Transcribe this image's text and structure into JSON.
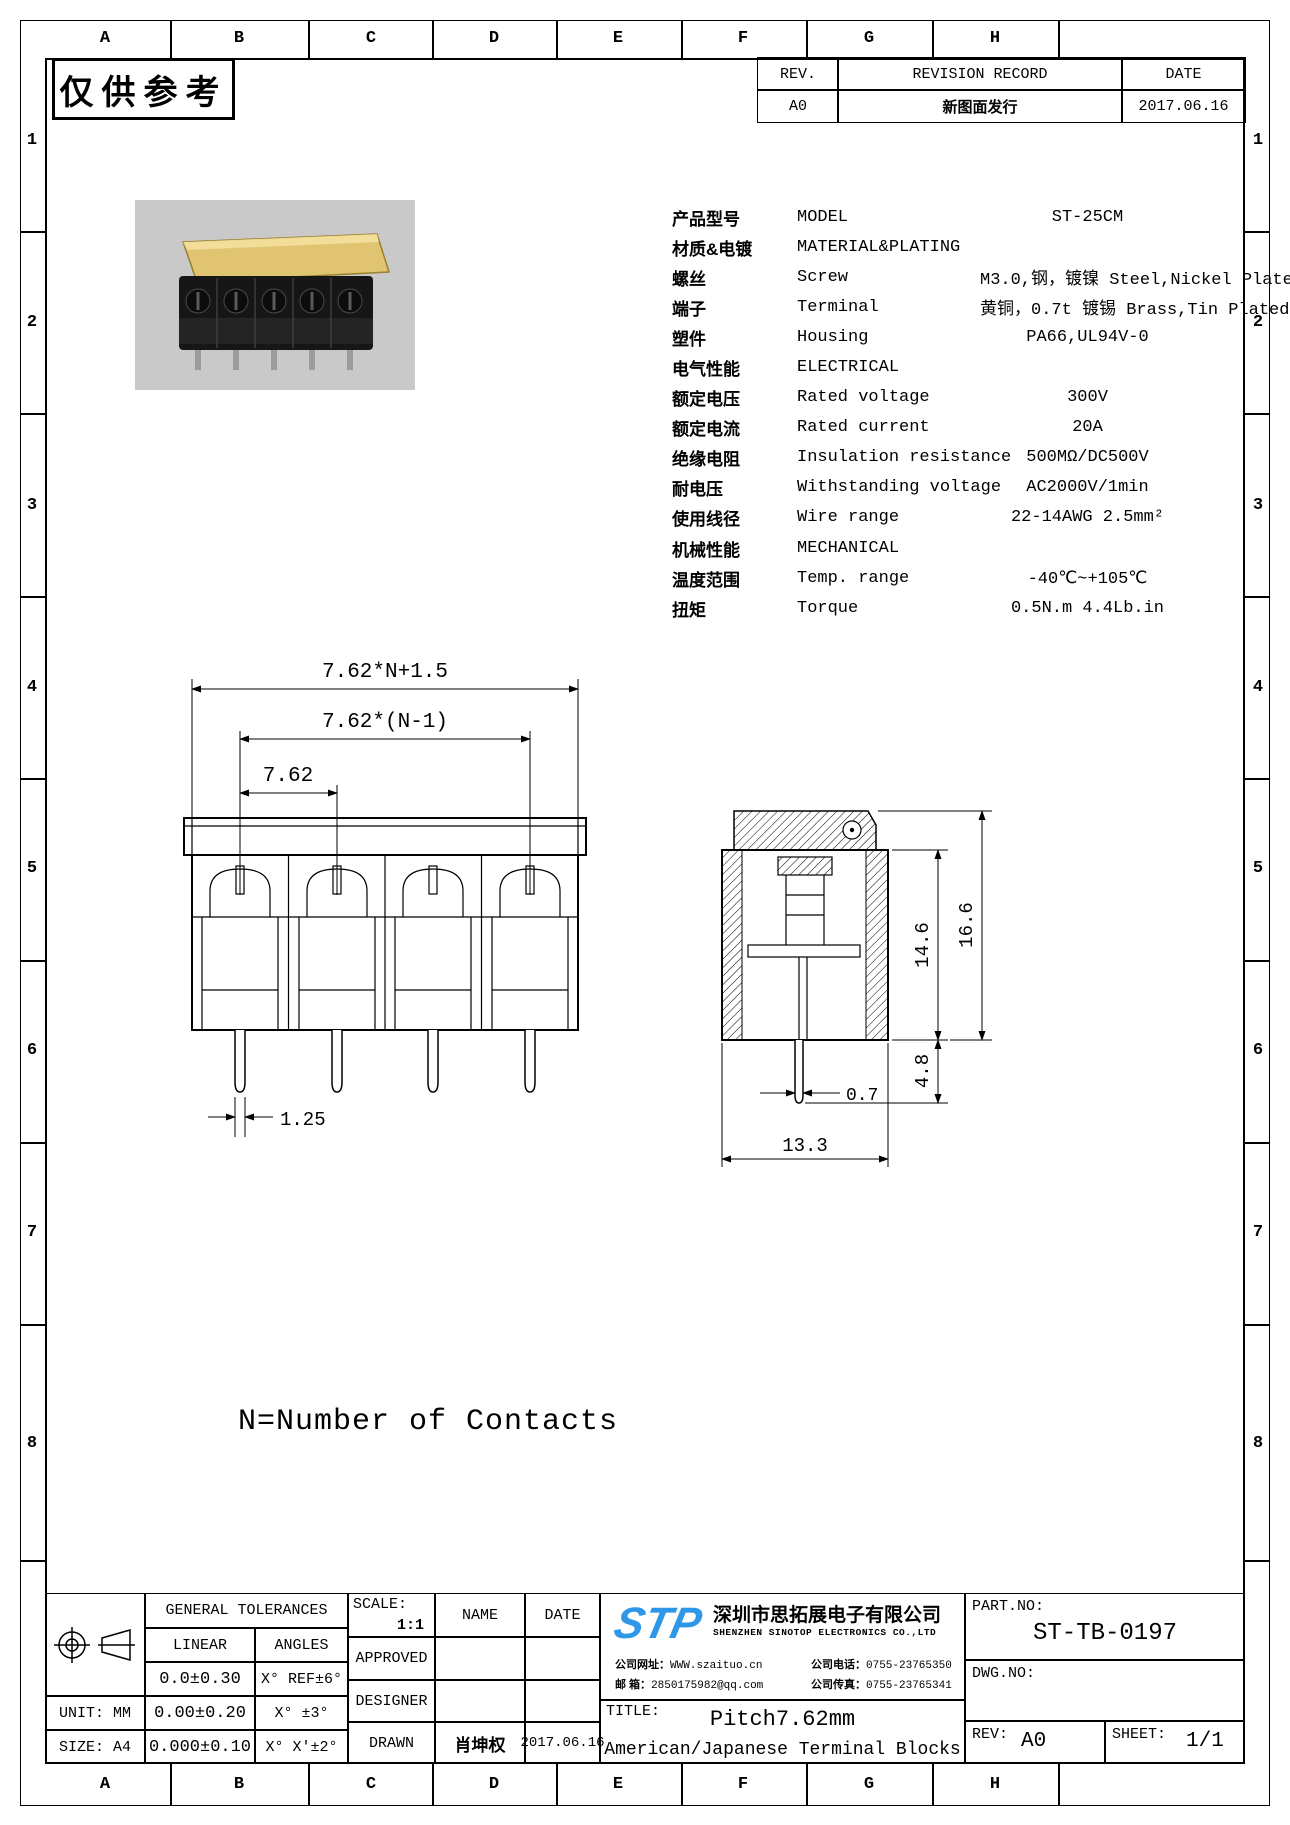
{
  "stamp": "仅供参考",
  "grid": {
    "cols": [
      "A",
      "B",
      "C",
      "D",
      "E",
      "F",
      "G",
      "H"
    ],
    "rows": [
      "1",
      "2",
      "3",
      "4",
      "5",
      "6",
      "7",
      "8"
    ]
  },
  "revision_table": {
    "rev_header": "REV.",
    "record_header": "REVISION RECORD",
    "date_header": "DATE",
    "row": {
      "rev": "A0",
      "record": "新图面发行",
      "date": "2017.06.16"
    }
  },
  "specs": {
    "rows": [
      {
        "cn": "产品型号",
        "en": "MODEL",
        "value": "ST-25CM"
      },
      {
        "cn": "材质&电镀",
        "en": "MATERIAL&PLATING",
        "value": ""
      },
      {
        "cn": "螺丝",
        "en": "Screw",
        "value": "M3.0,钢，镀镍 Steel,Nickel Plated"
      },
      {
        "cn": "端子",
        "en": "Terminal",
        "value": "黄铜，0.7t 镀锡 Brass,Tin Plated"
      },
      {
        "cn": "塑件",
        "en": "Housing",
        "value": "PA66,UL94V-0"
      },
      {
        "cn": "电气性能",
        "en": "ELECTRICAL",
        "value": ""
      },
      {
        "cn": "额定电压",
        "en": "Rated voltage",
        "value": "300V"
      },
      {
        "cn": "额定电流",
        "en": "Rated current",
        "value": "20A"
      },
      {
        "cn": "绝缘电阻",
        "en": "Insulation resistance",
        "value": "500MΩ/DC500V"
      },
      {
        "cn": "耐电压",
        "en": "Withstanding voltage",
        "value": "AC2000V/1min"
      },
      {
        "cn": "使用线径",
        "en": "Wire range",
        "value": "22-14AWG 2.5mm²"
      },
      {
        "cn": "机械性能",
        "en": "MECHANICAL",
        "value": ""
      },
      {
        "cn": "温度范围",
        "en": "Temp. range",
        "value": "-40℃~+105℃"
      },
      {
        "cn": "扭矩",
        "en": "Torque",
        "value": "0.5N.m 4.4Lb.in"
      }
    ]
  },
  "dims": {
    "overall": "7.62*N+1.5",
    "between": "7.62*(N-1)",
    "pitch": "7.62",
    "pin_w": "1.25",
    "h_body": "14.6",
    "h_total": "16.6",
    "pin_len": "4.8",
    "pin_t": "0.7",
    "depth": "13.3",
    "note": "N=Number of Contacts"
  },
  "title_block": {
    "general_tolerances": "GENERAL TOLERANCES",
    "linear_label": "LINEAR",
    "angles_label": "ANGLES",
    "tol1_linear": "0.0±0.30",
    "tol1_angle": "X° REF±6°",
    "tol2_linear": "0.00±0.20",
    "tol2_angle": "X°  ±3°",
    "tol3_linear": "0.000±0.10",
    "tol3_angle": "X° X'±2°",
    "unit_label": "UNIT: MM",
    "size_label": "SIZE: A4",
    "scale_label": "SCALE:",
    "scale_value": "1:1",
    "name_label": "NAME",
    "date_label": "DATE",
    "approved_label": "APPROVED",
    "designer_label": "DESIGNER",
    "drawn_label": "DRAWN",
    "drawn_name": "肖坤权",
    "drawn_date": "2017.06.16",
    "company": {
      "logo": "STP",
      "name_cn": "深圳市思拓展电子有限公司",
      "name_en": "SHENZHEN SINOTOP ELECTRONICS CO.,LTD",
      "website_label": "公司网址：",
      "website": "WWW.szaituo.cn",
      "email_label": "邮  箱：",
      "email": "2850175982@qq.com",
      "phone_label": "公司电话：",
      "phone": "0755-23765350",
      "fax_label": "公司传真：",
      "fax": "0755-23765341"
    },
    "title_label": "TITLE:",
    "title_line1": "Pitch7.62mm",
    "title_line2": "American/Japanese Terminal Blocks",
    "part_no_label": "PART.NO:",
    "part_no": "ST-TB-0197",
    "dwg_no_label": "DWG.NO:",
    "rev_label": "REV:",
    "rev_value": "A0",
    "sheet_label": "SHEET:",
    "sheet_value": "1/1"
  },
  "colors": {
    "line": "#000000",
    "logo_blue": "#2e97e8",
    "photo_background": "#c9c9c9",
    "cover_amber": "#e6c35c"
  }
}
